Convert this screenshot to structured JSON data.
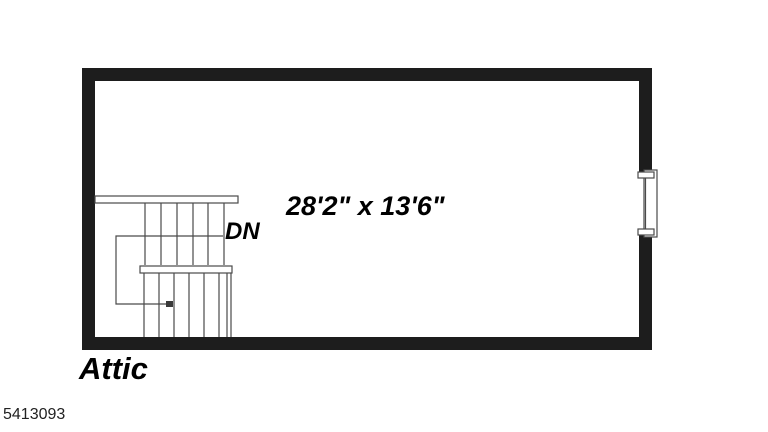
{
  "canvas": {
    "background": "#ffffff"
  },
  "floor_plan": {
    "room": {
      "name": "Attic",
      "dimensions": "28'2\" x 13'6\""
    },
    "stairs": {
      "label": "DN",
      "type": "switchback-two-runs-with-landing",
      "direction_arrow": "down"
    },
    "window": {
      "location": "right-wall"
    },
    "listing_id": "5413093",
    "colors": {
      "wall": "#1d1d1d",
      "stair_line": "#4a4a4a",
      "text": "#000000",
      "background": "#ffffff"
    }
  }
}
